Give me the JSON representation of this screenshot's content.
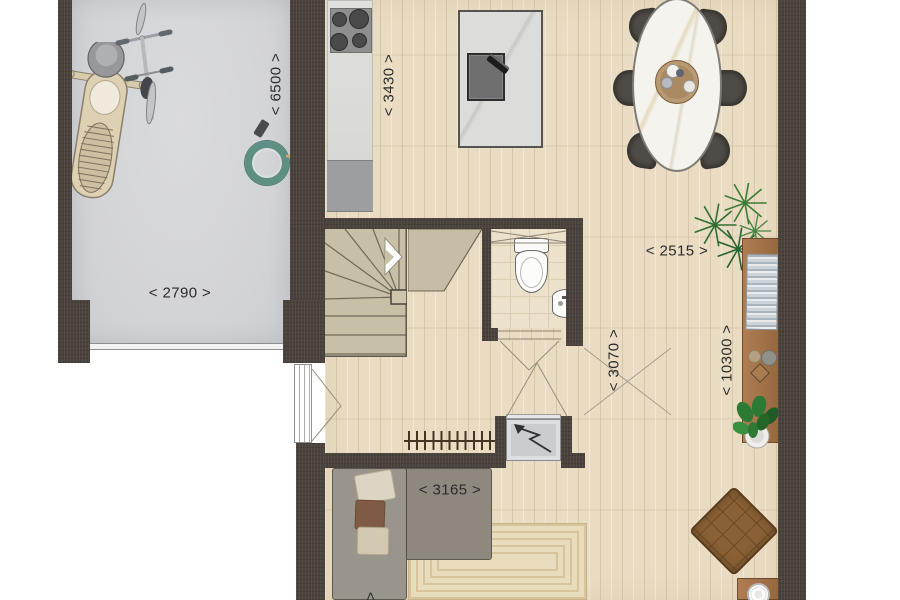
{
  "plan_type": "floor_plan",
  "dims": {
    "garage_length": "< 6500 >",
    "garage_width": "< 2790 >",
    "kitchen_width": "< 3430 >",
    "dining_width": "< 2515 >",
    "hall_depth": "< 3070 >",
    "house_depth": "< 10300 >",
    "sofa_width": "< 3165 >",
    "cutoff_arrow": ">"
  },
  "colors": {
    "wall": "#4a423c",
    "wood": "#eadcc2",
    "wood-line": "#d9c5a4",
    "garage-floor": "#d2d3d6",
    "stair": "#c8bfa7",
    "bath-floor": "#ece1cb",
    "rug": "#e9dcbd",
    "rug-line": "#d8c49c",
    "sofa": "#8e887e",
    "armchair": "#8a6134",
    "sideboard": "#96683f",
    "hose": "#5d8f85",
    "label-ink": "#2b2b2b"
  }
}
